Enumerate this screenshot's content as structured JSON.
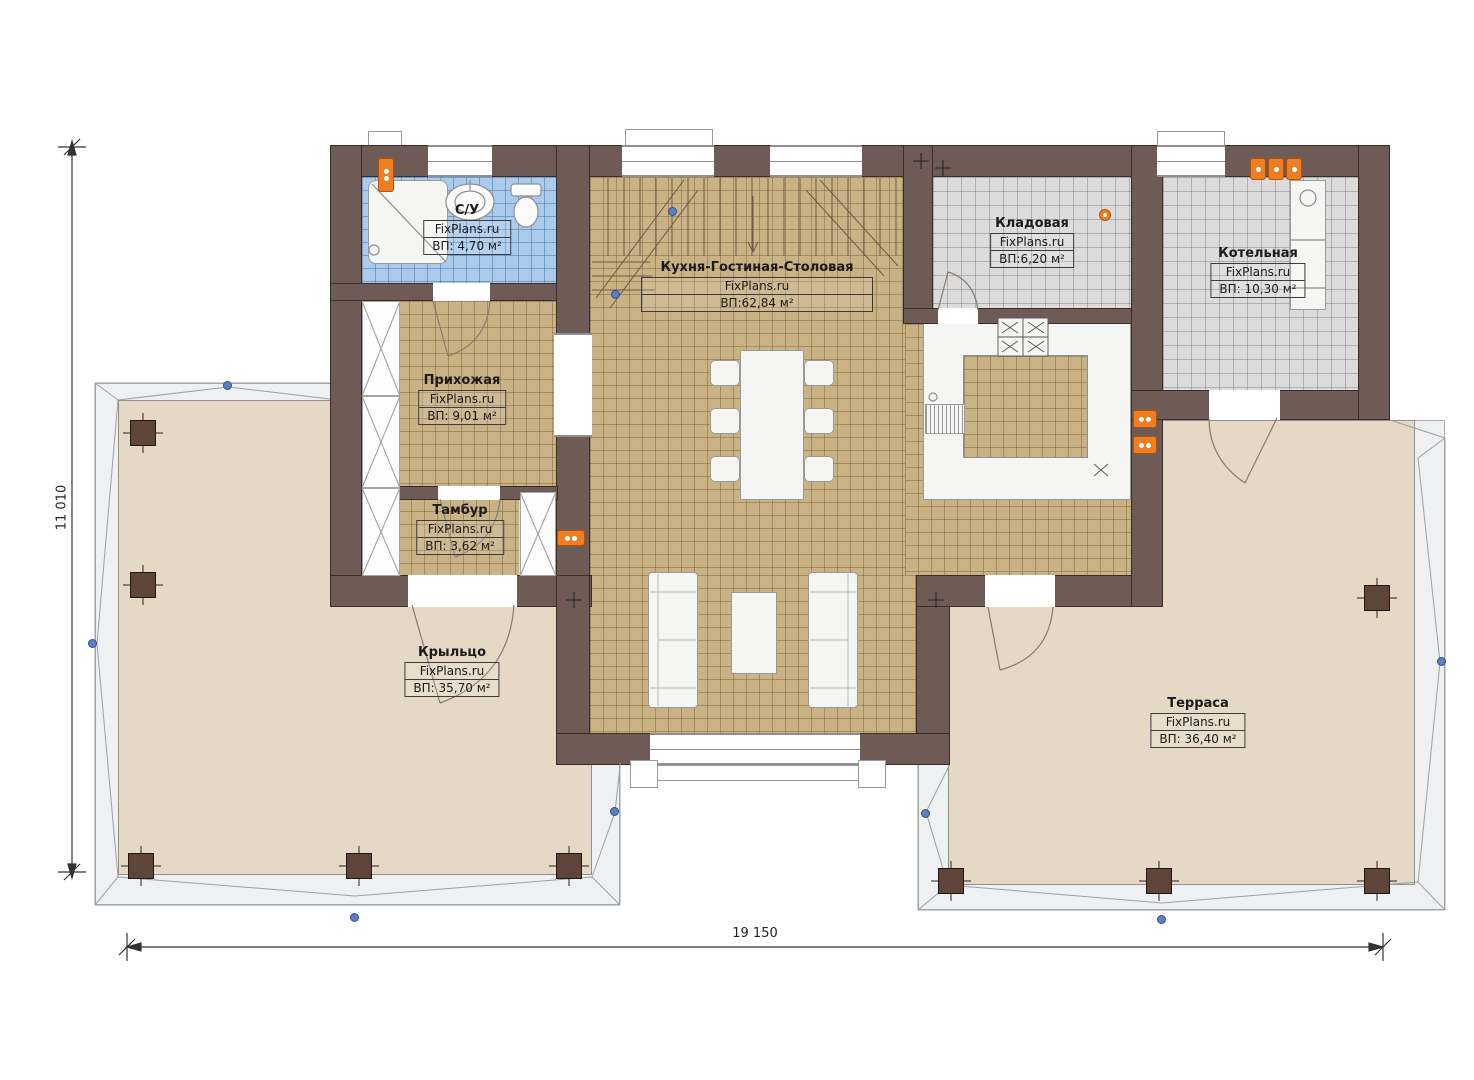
{
  "plan": {
    "dimension_height_label": "11 010",
    "dimension_width_label": "19 150"
  },
  "rooms": [
    {
      "id": "bathroom",
      "name": "С/У",
      "source": "FixPlans.ru",
      "area": "ВП: 4,70 м²"
    },
    {
      "id": "kitchen-living-dining",
      "name": "Кухня-Гостиная-Столовая",
      "source": "FixPlans.ru",
      "area": "ВП:62,84 м²"
    },
    {
      "id": "storage",
      "name": "Кладовая",
      "source": "FixPlans.ru",
      "area": "ВП:6,20 м²"
    },
    {
      "id": "boiler-room",
      "name": "Котельная",
      "source": "FixPlans.ru",
      "area": "ВП: 10,30 м²"
    },
    {
      "id": "hallway",
      "name": "Прихожая",
      "source": "FixPlans.ru",
      "area": "ВП: 9,01 м²"
    },
    {
      "id": "vestibule",
      "name": "Тамбур",
      "source": "FixPlans.ru",
      "area": "ВП: 3,62 м²"
    },
    {
      "id": "porch",
      "name": "Крыльцо",
      "source": "FixPlans.ru",
      "area": "ВП: 35,70 м²"
    },
    {
      "id": "terrace",
      "name": "Терраса",
      "source": "FixPlans.ru",
      "area": "ВП: 36,40 м²"
    }
  ],
  "colors": {
    "wall": "#6f5b55",
    "floor_wood": "#c9b284",
    "floor_tile_gray": "#dbdbdb",
    "floor_tile_blue": "#abcbec",
    "terrace_floor": "#e5d8c4",
    "roof_overhang": "#eef0f2",
    "post": "#5f443a",
    "lamp": "#ef7e22",
    "snap_marker": "#5b80c2"
  }
}
